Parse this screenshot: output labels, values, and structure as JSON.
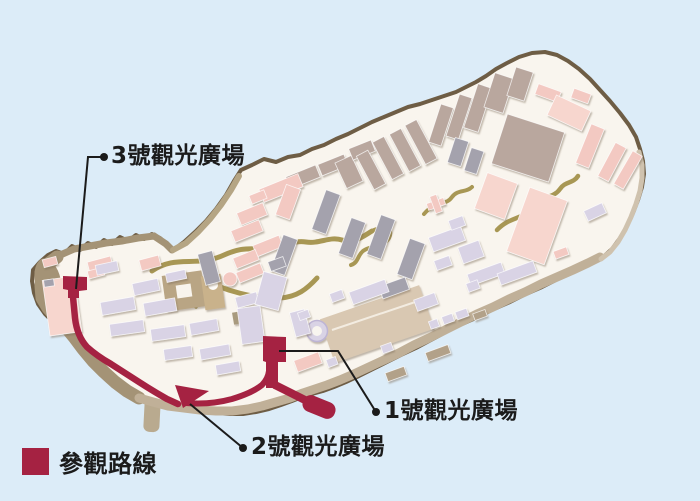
{
  "annotations": {
    "plaza3": {
      "text": "3號觀光廣場"
    },
    "plaza2": {
      "text": "2號觀光廣場"
    },
    "plaza1": {
      "text": "1號觀光廣場"
    }
  },
  "legend": {
    "route_label": "參觀路線",
    "route_color": "#a52242",
    "swatch_style": "background:#a52242"
  },
  "palette": {
    "sea": "#dcecf8",
    "island_fill": "#f9f5ee",
    "coastline": "#6e5d45",
    "seawall_west": "#a49376",
    "seawall_south": "#c0b098",
    "building_taupe": "#b9a79e",
    "building_pink": "#f3c9c2",
    "building_pale_pink": "#f7d6ce",
    "building_gray": "#a4a2ad",
    "building_lavender": "#d9d3e5",
    "path_olive": "#a89754",
    "tour_route_red": "#a52242",
    "callout_black": "#1b1b1b"
  }
}
